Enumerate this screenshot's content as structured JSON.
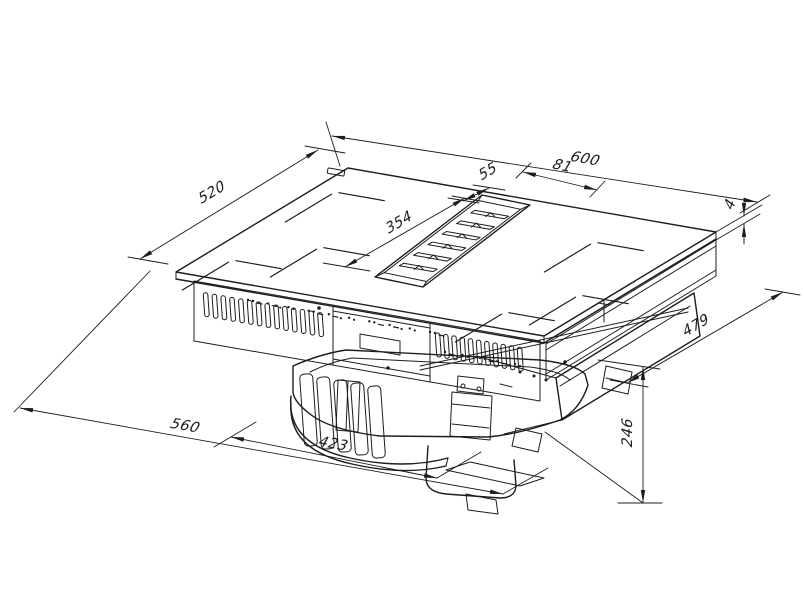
{
  "drawing": {
    "type": "isometric-technical-drawing",
    "subject": "induction hob with integrated downdraft extractor - dimensioned views",
    "unit": "mm",
    "line_color": "#1d1d1b",
    "background_color": "#ffffff",
    "dimensions": [
      {
        "name": "hob-width",
        "label": "600",
        "line": [
          332,
          136,
          757,
          202
        ],
        "label_pos": [
          583,
          163
        ],
        "label_rot": 10,
        "ext": [
          [
            326,
            122,
            340,
            166
          ],
          [
            740,
            213,
            770,
            195
          ]
        ]
      },
      {
        "name": "vent-offset-right",
        "label": "81",
        "line": [
          523,
          172,
          597,
          190
        ],
        "label_pos": [
          560,
          170
        ],
        "label_rot": 12,
        "ext": [
          [
            516,
            178,
            531,
            163
          ],
          [
            590,
            197,
            605,
            181
          ]
        ]
      },
      {
        "name": "vent-width",
        "label": "55",
        "line": [
          463,
          201,
          489,
          188
        ],
        "label_pos": [
          489,
          176
        ],
        "label_rot": -31,
        "ext": [
          [
            448,
            198,
            479,
            203
          ],
          [
            473,
            185,
            505,
            190
          ]
        ]
      },
      {
        "name": "vent-offset-front",
        "label": "354",
        "line": [
          345,
          267,
          465,
          198
        ],
        "label_pos": [
          400,
          227
        ],
        "label_rot": -31,
        "ext": [
          [
            323,
            263,
            370,
            271
          ],
          [
            452,
            196,
            480,
            201
          ]
        ]
      },
      {
        "name": "hob-depth",
        "label": "520",
        "line": [
          140,
          259,
          318,
          150
        ],
        "label_pos": [
          213,
          197
        ],
        "label_rot": -31,
        "ext": [
          [
            128,
            257,
            168,
            264
          ],
          [
            305,
            146,
            345,
            153
          ]
        ]
      },
      {
        "name": "glass-thickness",
        "label": "4",
        "line": null,
        "label_pos": [
          734,
          207
        ],
        "label_rot": -72,
        "ext": [
          [
            716,
            232,
            762,
            205
          ],
          [
            716,
            240,
            760,
            214
          ]
        ],
        "arrow_lines": [
          [
            744,
            198,
            744,
            216
          ],
          [
            744,
            244,
            744,
            224
          ]
        ],
        "arrows": [
          [
            744,
            216,
            90
          ],
          [
            744,
            224,
            -90
          ]
        ]
      },
      {
        "name": "lower-unit-depth",
        "label": "479",
        "line": [
          627,
          383,
          783,
          292
        ],
        "label_pos": [
          697,
          330
        ],
        "label_rot": -31,
        "ext": [
          [
            610,
            380,
            648,
            387
          ],
          [
            765,
            289,
            800,
            295
          ]
        ]
      },
      {
        "name": "below-top-height",
        "label": "246",
        "line": [
          643,
          367,
          643,
          503
        ],
        "label_pos": [
          632,
          434
        ],
        "label_rot": -90,
        "ext": [
          [
            598,
            360,
            660,
            369
          ],
          [
            618,
            503,
            662,
            503
          ],
          [
            545,
            432,
            643,
            503
          ]
        ]
      },
      {
        "name": "cutout-width",
        "label": "560",
        "line": [
          20,
          408,
          503,
          494
        ],
        "label_pos": [
          183,
          430
        ],
        "label_rot": 10,
        "ext": [
          [
            150,
            271,
            14,
            412
          ],
          [
            503,
            494,
            548,
            468
          ]
        ]
      },
      {
        "name": "blower-unit-width",
        "label": "423",
        "line": [
          231,
          437,
          437,
          478
        ],
        "label_pos": [
          331,
          448
        ],
        "label_rot": 10,
        "ext": [
          [
            214,
            447,
            256,
            422
          ],
          [
            437,
            478,
            481,
            452
          ]
        ]
      }
    ],
    "axes": {
      "u": [
        0.986,
        0.172
      ],
      "v": [
        0.856,
        -0.517
      ]
    },
    "glass_top": {
      "left": [
        176,
        272
      ],
      "back": [
        348,
        168
      ],
      "right": [
        716,
        232
      ],
      "front": [
        544,
        336
      ],
      "thickness_px": 7
    },
    "logo_plate": {
      "center": [
        336,
        172
      ],
      "w": 17,
      "h": 5.5,
      "rot": 10
    },
    "vent": {
      "outer": [
        [
          530,
          205
        ],
        [
          482,
          195
        ],
        [
          375,
          277
        ],
        [
          423,
          287
        ]
      ],
      "slat_count": 6,
      "mid_back": [
        504,
        204
      ],
      "mid_front": [
        404,
        278
      ]
    },
    "zone_marks": {
      "left_half": [
        [
          335,
          192
        ],
        [
          320,
          247
        ],
        [
          232,
          260
        ]
      ],
      "right_half": [
        [
          594,
          242
        ],
        [
          579,
          295
        ],
        [
          505,
          312
        ]
      ]
    },
    "front_slots": {
      "left_row": {
        "x0": 204,
        "count": 14,
        "step": 8.8
      },
      "right_row": {
        "x0": 436,
        "count": 11,
        "step": 8.2
      },
      "top_edge": {
        "x": 194,
        "y": 281,
        "slope": 0.1735
      },
      "slot_w": 4.5,
      "slot_h": 24
    },
    "control_glyph_rows": [
      {
        "from": [
          248,
          300
        ],
        "to": [
          430,
          332
        ],
        "count": 10
      },
      {
        "from": [
          445,
          352
        ],
        "to": [
          515,
          364
        ],
        "count": 5
      }
    ],
    "screws": [
      [
        319,
        308
      ],
      [
        388,
        368
      ],
      [
        565,
        362
      ]
    ]
  }
}
